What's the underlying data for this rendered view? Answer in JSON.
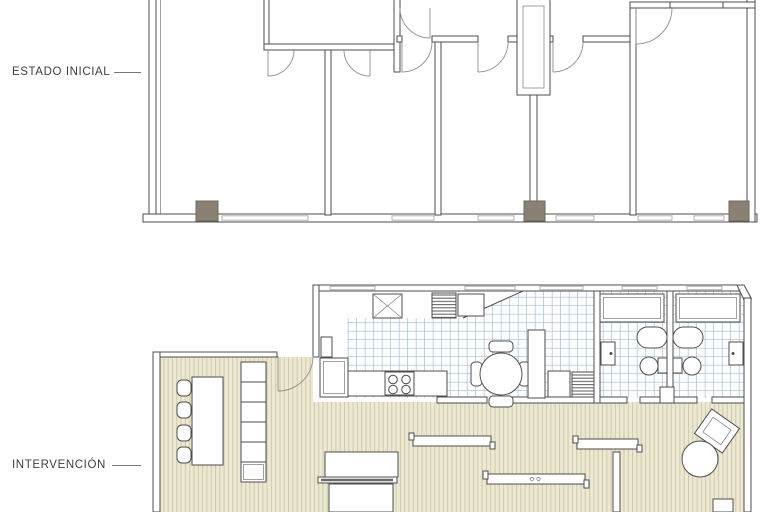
{
  "sheet": {
    "labels": {
      "top": "ESTADO INICIAL",
      "bottom": "INTERVENCIÓN"
    }
  },
  "colors": {
    "paper": "#ffffff",
    "label_text": "#3f3f3f",
    "wall": "#4d4d4d",
    "line_light": "#8a8a8a",
    "window": "#b3b3b3",
    "pillar": "#8b8173",
    "wood_bg": "#ede8d2",
    "wood_stripe": "#cfc9ad",
    "tile_bg": "#fdfdfe",
    "tile_line": "#a3bdd6"
  },
  "icons": [
    "pillar-icon",
    "door-swing-icon",
    "window-icon",
    "stove-icon",
    "fridge-icon",
    "kitchen-counter-icon",
    "round-dining-table-icon",
    "chair-icon",
    "long-table-icon",
    "shelf-icon",
    "skylight-x-icon",
    "vent-grille-icon",
    "washer-icon",
    "cabinet-icon",
    "shower-tray-icon",
    "bathtub-icon",
    "toilet-icon",
    "sink-icon",
    "bed-icon",
    "sliding-panel-icon",
    "round-table-icon",
    "armchair-icon"
  ]
}
